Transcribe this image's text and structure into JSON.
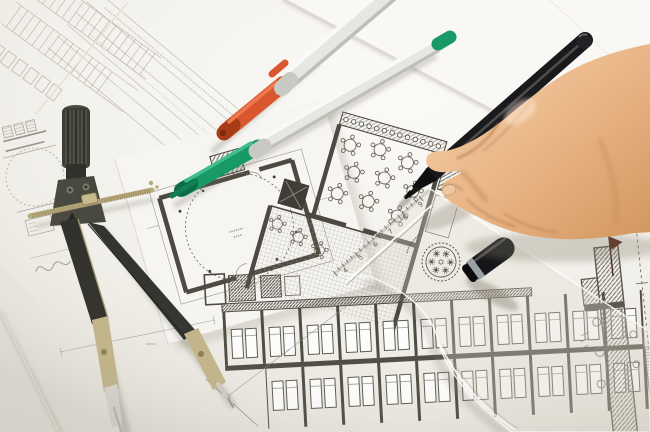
{
  "colors": {
    "paper-base": "#f1efe9",
    "paper-bright": "#fbfaf7",
    "paper-shade": "#e1ded6",
    "sheet-edge": "#dcd8d0",
    "line": "#8f8d82",
    "wall": "#4b4940",
    "hatch": "#6e6c62",
    "compass-dark": "#2f2f29",
    "compass-mid": "#45453c",
    "brass": "#b9aa7c",
    "brass-deep": "#8a7c52",
    "steel": "#d3d1ca",
    "barrel": "#ebebe8",
    "barrel-shade": "#bfbfb9",
    "barrel-hi": "#f9f9f7",
    "cap-orange": "#d8572c",
    "cap-orange-deep": "#a83c16",
    "cap-green": "#179a66",
    "cap-green-deep": "#0c6b45",
    "ink": "#17171b",
    "skin-hi": "#f5d2ab",
    "skin-mid": "#e8b384",
    "skin-lo": "#d2975f",
    "crease": "#b97a4a",
    "stamp-ink": "#57554b"
  },
  "ruler": {
    "scale_numbers": [
      "4",
      "5",
      "6",
      "7",
      "8",
      "9"
    ]
  },
  "objects": {
    "labels": [
      "blueprint-sheets",
      "floor-plan-drawings",
      "drafting-compass",
      "orange-felt-pen",
      "green-felt-pen",
      "black-fineliner-pen",
      "black-pen-cap",
      "transparent-set-square",
      "right-hand-holding-pen"
    ]
  }
}
